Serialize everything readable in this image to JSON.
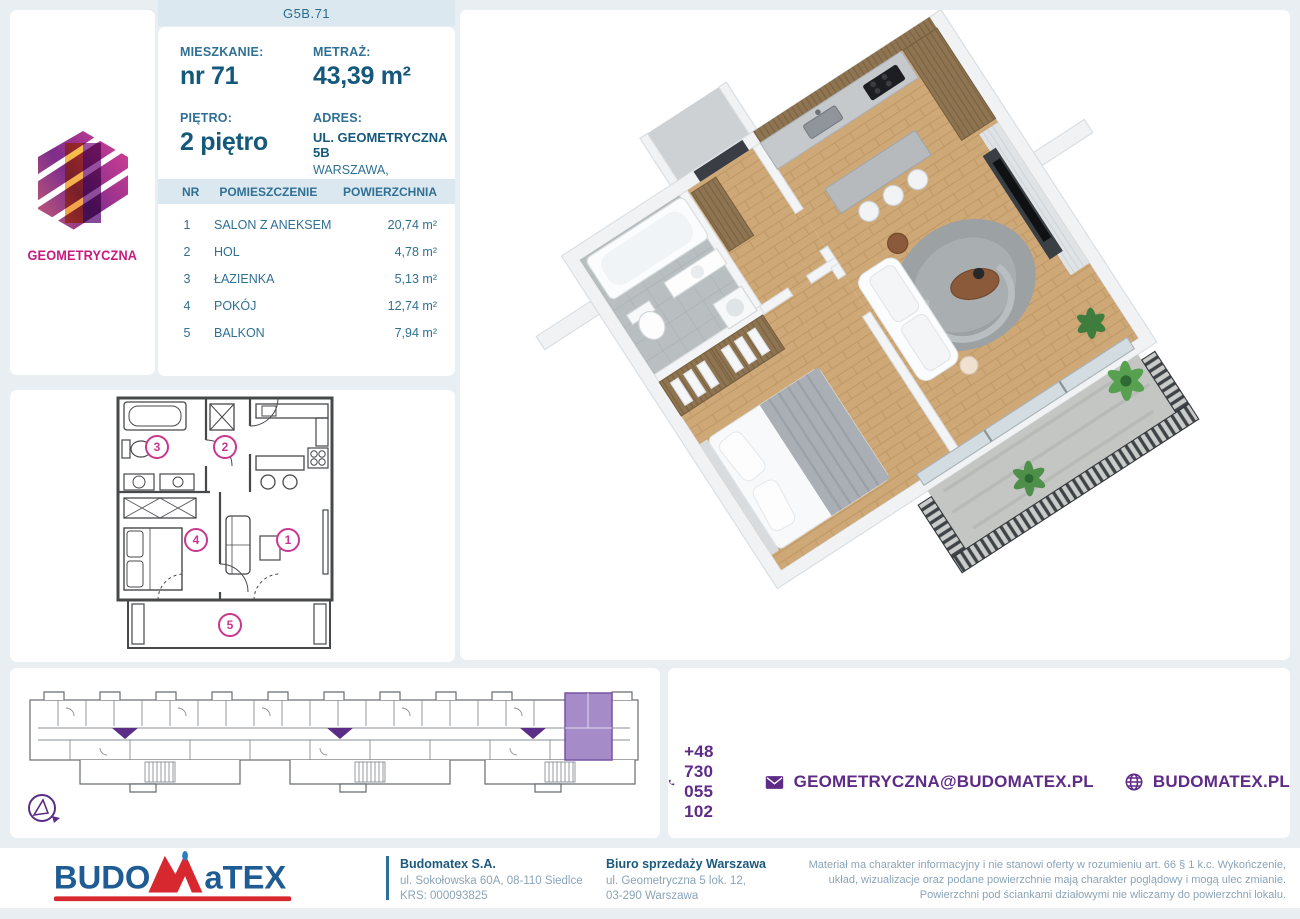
{
  "header": {
    "unit_code": "G5B.71"
  },
  "brand": {
    "name": "GEOMETRYCZNA"
  },
  "info": {
    "apartment_label": "MIESZKANIE:",
    "apartment_value": "nr 71",
    "area_label": "METRAŻ:",
    "area_value": "43,39 m²",
    "floor_label": "PIĘTRO:",
    "floor_value": "2 piętro",
    "address_label": "ADRES:",
    "address_line1": "UL. GEOMETRYCZNA 5B",
    "address_line2": "WARSZAWA, BIAŁOŁĘKA"
  },
  "rooms": {
    "headers": {
      "nr": "NR",
      "name": "POMIESZCZENIE",
      "area": "POWIERZCHNIA"
    },
    "rows": [
      {
        "nr": "1",
        "name": "SALON Z ANEKSEM",
        "area": "20,74 m²"
      },
      {
        "nr": "2",
        "name": "HOL",
        "area": "4,78 m²"
      },
      {
        "nr": "3",
        "name": "ŁAZIENKA",
        "area": "5,13 m²"
      },
      {
        "nr": "4",
        "name": "POKÓJ",
        "area": "12,74 m²"
      },
      {
        "nr": "5",
        "name": "BALKON",
        "area": "7,94 m²"
      }
    ]
  },
  "plan2d": {
    "labels": {
      "r1": "1",
      "r2": "2",
      "r3": "3",
      "r4": "4",
      "r5": "5"
    }
  },
  "contact": {
    "phone": "+48 730 055 102",
    "email": "GEOMETRYCZNA@BUDOMATEX.PL",
    "website": "BUDOMATEX.PL"
  },
  "footer": {
    "logo": {
      "part1": "BUDO",
      "part2": "M",
      "part3": "aTEX"
    },
    "company_name": "Budomatex S.A.",
    "company_address": "ul. Sokołowska 60A, 08-110 Siedlce",
    "company_krs": "KRS: 000093825",
    "office_name": "Biuro sprzedaży Warszawa",
    "office_address1": "ul. Geometryczna 5 lok. 12,",
    "office_address2": "03-290 Warszawa",
    "disclaimer": "Materiał ma charakter informacyjny i nie stanowi oferty w rozumieniu art. 66 § 1 k.c. Wykończenie, układ, wizualizacje oraz podane powierzchnie mają charakter poglądowy i mogą ulec zmianie. Powierzchni pod ściankami działowymi nie wliczamy do powierzchni lokalu."
  },
  "colors": {
    "page_bg": "#e9eef3",
    "strip_bg": "#dce8ef",
    "dark_blue": "#14587c",
    "mid_blue": "#2f7094",
    "purple": "#5e2b87",
    "purple_unit": "#a58bc8",
    "magenta": "#c9368f",
    "brand_magenta": "#c9197f",
    "logo_red": "#d7282f",
    "logo_blue": "#1f5c94"
  }
}
